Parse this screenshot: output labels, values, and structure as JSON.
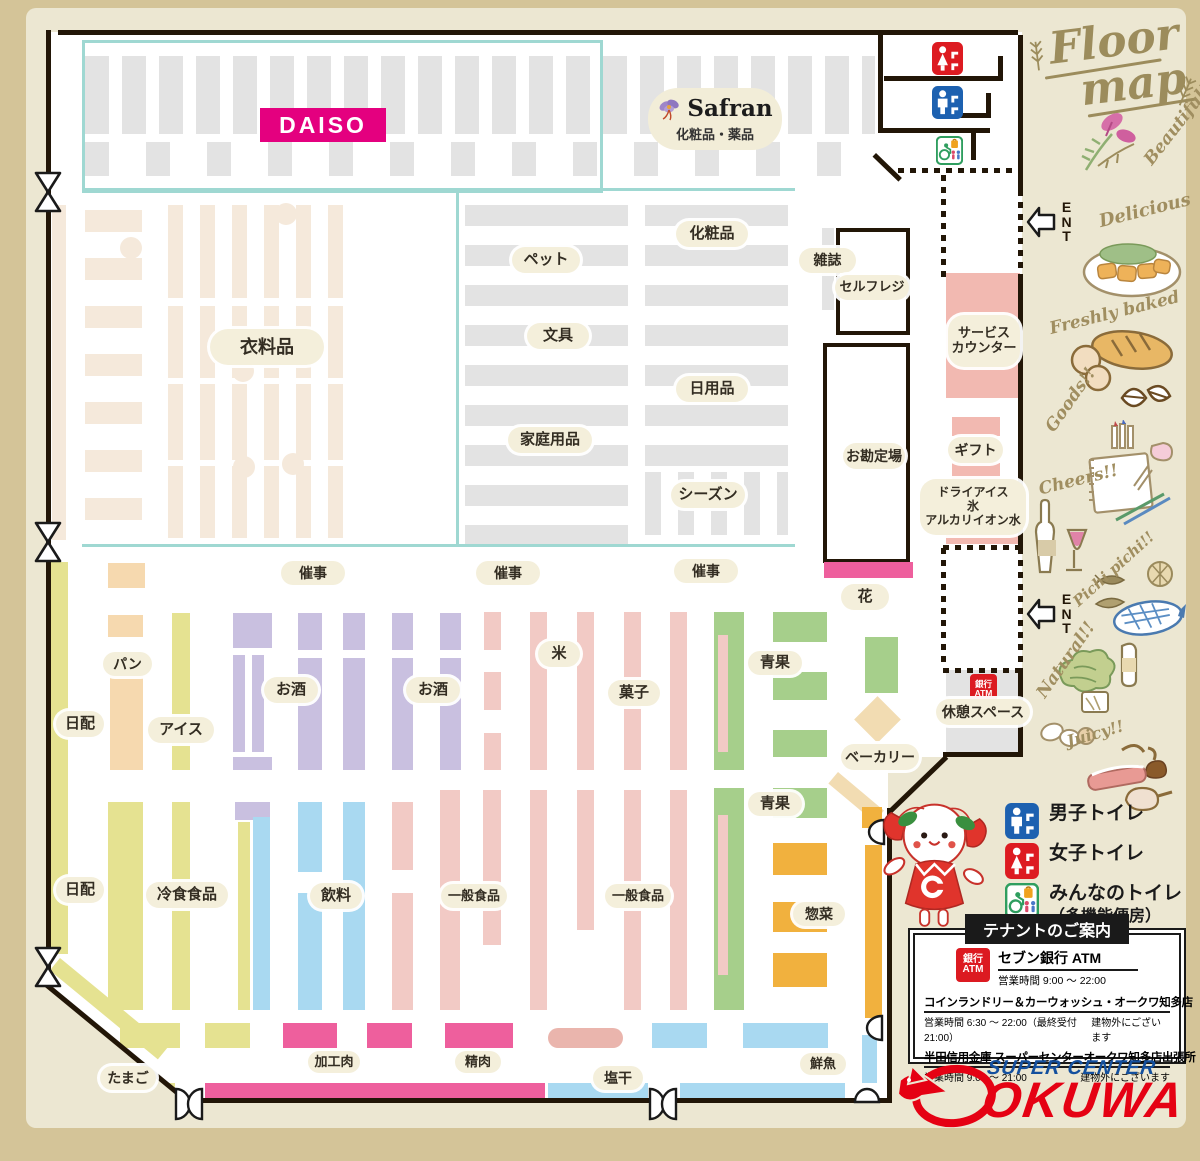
{
  "title": {
    "line1": "Floor",
    "line2": "map"
  },
  "margin": {
    "ent": "ENT",
    "decorations": [
      "Beautiful!!",
      "Delicious",
      "Freshly baked",
      "Goods!!",
      "Cheers!!",
      "Pichi pichi!!",
      "Natural!!",
      "Juicy!!"
    ]
  },
  "brands": {
    "daiso": "DAISO",
    "safran": "Safran",
    "safran_sub": "化粧品・薬品"
  },
  "sections": {
    "clothing": "衣料品",
    "pet": "ペット",
    "stationery": "文具",
    "household": "家庭用品",
    "cosmetics": "化粧品",
    "daily_goods": "日用品",
    "season": "シーズン",
    "magazines": "雑誌",
    "self_checkout": "セルフレジ",
    "service_counter": "サービス\nカウンター",
    "checkout": "お勘定場",
    "gift": "ギフト",
    "dry_ice": "ドライアイス\n氷\nアルカリイオン水",
    "flowers": "花",
    "event": "催事",
    "bread": "パン",
    "daily": "日配",
    "ice_cream": "アイス",
    "sake": "お酒",
    "rice": "米",
    "sweets": "菓子",
    "produce": "青果",
    "frozen_food": "冷食食品",
    "beverages": "飲料",
    "general_food": "一般食品",
    "deli": "惣菜",
    "bakery": "ベーカリー",
    "rest_space": "休憩スペース",
    "eggs": "たまご",
    "processed_meat": "加工肉",
    "meat": "精肉",
    "salted_dried": "塩干",
    "fresh_fish": "鮮魚"
  },
  "atm": {
    "l1": "銀行",
    "l2": "ATM"
  },
  "legend": {
    "men": "男子トイレ",
    "women": "女子トイレ",
    "everyone": "みんなのトイレ",
    "everyone_sub": "（多機能便房）"
  },
  "tenant": {
    "title": "テナントのご案内",
    "atm_name": "セブン銀行 ATM",
    "atm_hours": "営業時間 9:00 ～ 22:00",
    "rows": [
      {
        "name": "コインランドリー＆カーウォッシュ・オークワ知多店",
        "hours": "営業時間 6:30 ～ 22:00（最終受付 21:00）",
        "note": "建物外にございます"
      },
      {
        "name": "半田信用金庫 スーパーセンターオークワ知多店出張所",
        "hours": "営業時間 9:00 ～ 21:00",
        "note": "建物外にございます"
      }
    ]
  },
  "logo": {
    "super_center": "SUPER CENTER",
    "okuwa": "OKUWA"
  },
  "colors": {
    "daiso_pink": "#e4007f",
    "okuwa_red": "#e50113",
    "okuwa_blue": "#14509e",
    "wall": "#221607",
    "teal": "#9fd8d2",
    "toilet_blue": "#1d61b0",
    "toilet_red": "#dd1b21",
    "toilet_green": "#2f9e5f"
  }
}
